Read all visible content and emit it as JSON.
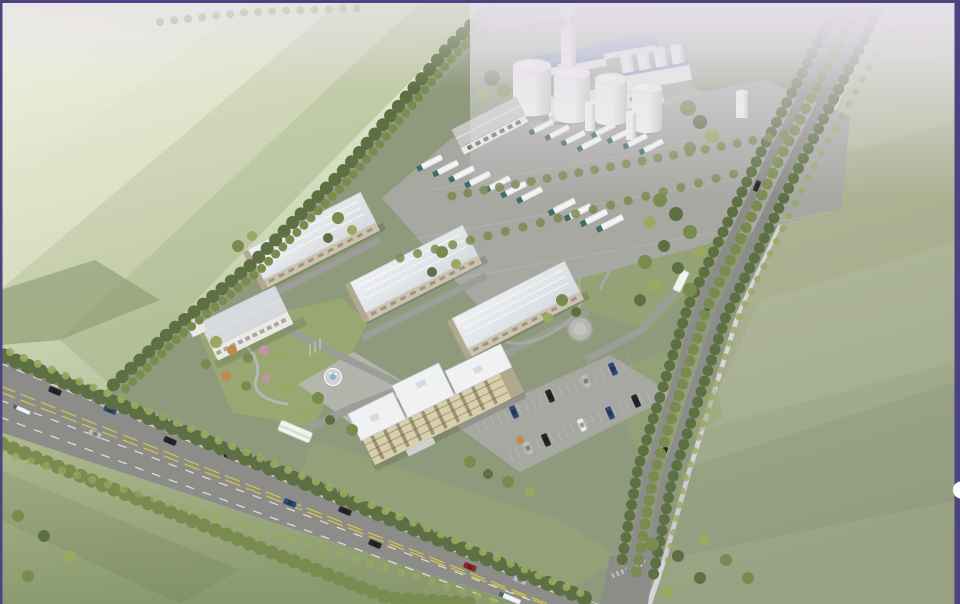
{
  "slide": {
    "kind": "presentation-image-slide",
    "frame_border_color": "#4e4381",
    "nav_button": {
      "shape": "half-circle",
      "color": "#ffffff",
      "position": "right-edge"
    }
  },
  "scene": {
    "subject": "aerial-3d-rendering-of-industrial-campus",
    "view": "birds-eye-perspective-from-southwest",
    "objects": {
      "chimney_stack": 1,
      "large_storage_tanks": 4,
      "small_storage_tanks": 4,
      "small_silos": 3,
      "blue_roof_plant_buildings": 2,
      "industrial_building": 1,
      "weighbridge_canopy": 1,
      "warehouses": 3,
      "office_building": 1,
      "main_administration_building": 1,
      "administration_floors": 5,
      "tanker_trucks": 19,
      "truck_rows": 5,
      "parked_cars": 9,
      "public_road_vehicles": 13,
      "boundary_road_vehicles": 3,
      "entrance_gates": 2,
      "fountain": 1,
      "circular_plaza": 1,
      "flagpoles": 3,
      "tree_lined_boundary_roads": 2
    }
  },
  "palette": {
    "bg_haze": "#d8d4dc",
    "haze": "#e6e1ea",
    "field_pale": "#f2f2e4",
    "field_mid": "#dfe3ca",
    "field_deep": "#bcc6a2",
    "field_band": "#a3b186",
    "field_bl_light": "#aeb88e",
    "field_bl_dark": "#8a9a6e",
    "field_r_light": "#b9bf9f",
    "field_r_dark": "#98a283",
    "site_green": "#8f9a7c",
    "lawn_green": "#9aa873",
    "lawn_dark": "#7e9160",
    "paving": "#a8a8a3",
    "paving_light": "#b7b7b1",
    "road": "#8c8d88",
    "road_light": "#9c9d96",
    "lane_white": "#ebe9e2",
    "lane_yellow": "#d3c24b",
    "tree_dark": "#5d7043",
    "tree_mid": "#7a8b4f",
    "tree_light": "#9aa862",
    "autumn_orange": "#bf8a50",
    "autumn_pink": "#c494a6",
    "roof_white": "#eff1f3",
    "roof_gray": "#d6dade",
    "roof_blue": "#5d7cab",
    "wall_white": "#eae9e4",
    "wall_beige": "#ccc3af",
    "wall_end": "#b2a88f",
    "cream": "#d9cfab",
    "window_dark": "#5f574a",
    "tank_light": "#f1f1ee",
    "tank_shade": "#c5c5bf",
    "truck_white": "#e9eded",
    "truck_cab": "#3f6b68",
    "car_black": "#26262a",
    "car_navy": "#2e4a78",
    "car_silver": "#b9bcc0",
    "car_white": "#e9e9e9",
    "car_red": "#8e2722",
    "gate_white": "#f2f2ee",
    "border_purple": "#4e4381"
  }
}
